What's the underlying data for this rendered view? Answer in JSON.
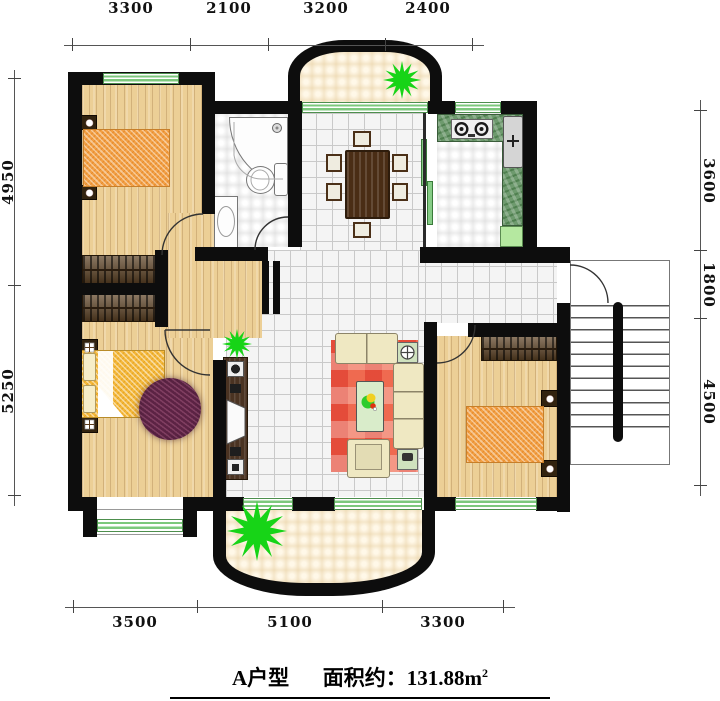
{
  "title": {
    "unit_name": "A户型",
    "area_prefix": "面积约：131.88m",
    "area_exponent": "2"
  },
  "dimensions": {
    "top": [
      "3300",
      "2100",
      "3200",
      "2400"
    ],
    "bottom": [
      "3500",
      "5100",
      "3300"
    ],
    "left": [
      "4950",
      "5250"
    ],
    "right": [
      "3600",
      "1800",
      "4500"
    ]
  },
  "colors": {
    "wall": "#0d0d0d",
    "wood_floor": "#eccf96",
    "tile_floor": "#f4f4f4",
    "balcony_floor": "#fdf3dd",
    "kitchen_counter_green": "#6e9a6e",
    "window_green": "#7cc87c",
    "living_rug_red": "#ef6a50",
    "round_rug_purple": "#5c2344",
    "mattress_orange": "#f2a044",
    "double_bed_yellow": "#f4b83a",
    "plant_green": "#17d417",
    "sofa_cream": "#efe8c2",
    "wardrobe_brown": "#5f4426"
  },
  "icons": {
    "plant": "plant-icon",
    "lamp": "table-lamp-icon",
    "burner": "stove-burner-icon",
    "shower": "shower-head-icon"
  }
}
